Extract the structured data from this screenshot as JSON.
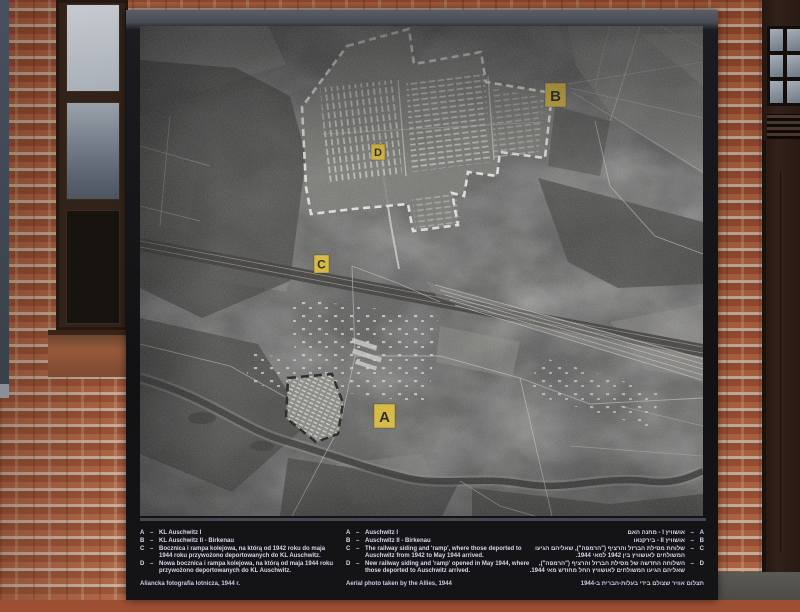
{
  "board": {
    "photo": {
      "labels": [
        {
          "letter": "A"
        },
        {
          "letter": "B"
        },
        {
          "letter": "C"
        },
        {
          "letter": "D"
        }
      ]
    },
    "captions": {
      "separator": "–",
      "polish": {
        "items": [
          {
            "key": "A",
            "text": "KL Auschwitz I"
          },
          {
            "key": "B",
            "text": "KL Auschwitz II - Birkenau"
          },
          {
            "key": "C",
            "text": "Bocznica i rampa kolejowa, na którą od 1942 roku do maja 1944 roku przywożono deportowanych do KL Auschwitz."
          },
          {
            "key": "D",
            "text": "Nowa bocznica i rampa kolejowa, na którą od maja 1944 roku przywożono deportowanych do KL Auschwitz."
          }
        ],
        "footer": "Aliancka fotografia lotnicza, 1944 r."
      },
      "english": {
        "items": [
          {
            "key": "A",
            "text": "Auschwitz I"
          },
          {
            "key": "B",
            "text": "Auschwitz II - Birkenau"
          },
          {
            "key": "C",
            "text": "The railway siding and 'ramp', where those deported to Auschwitz from 1942 to May 1944 arrived."
          },
          {
            "key": "D",
            "text": "New railway siding and 'ramp' opened in May 1944, where those deported to Auschwitz arrived."
          }
        ],
        "footer": "Aerial photo taken by the Allies, 1944"
      },
      "hebrew": {
        "items": [
          {
            "key": "A",
            "text": "אושוויץ I - מחנה האם"
          },
          {
            "key": "B",
            "text": "אושוויץ II - בירקנאו"
          },
          {
            "key": "C",
            "text": "שלוחת מסילת הברזל והרציף (\"הרמפה\"), שאליהם הגיעו המשולחים לאושוויץ בין 1942 למאי 1944."
          },
          {
            "key": "D",
            "text": "השלוחה החדשה של מסילת הברזל והרציף (\"הרמפה\"), שאליהם הגיעו המשולחים לאושוויץ החל מחודש מאי 1944."
          }
        ],
        "footer": "תצלום אוויר שצולם בידי בעלות-הברית ב-1944"
      }
    }
  }
}
